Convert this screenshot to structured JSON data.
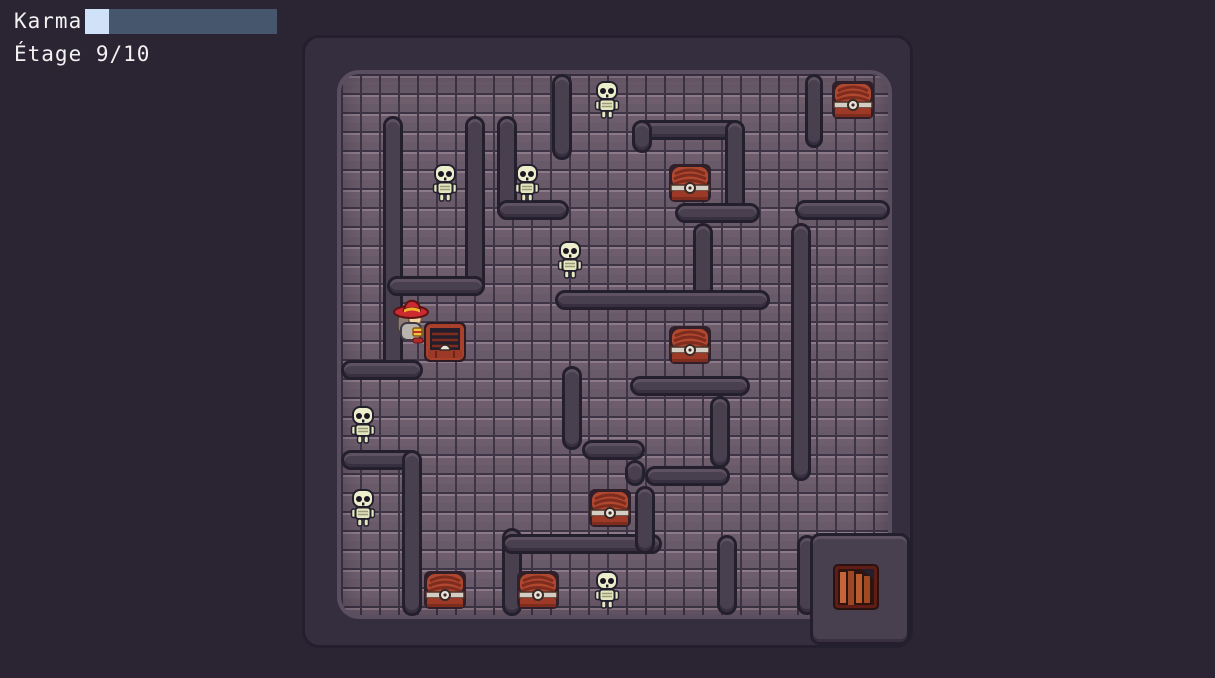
{
  "hud": {
    "karma_label": "Karma",
    "karma_percent": 12.5,
    "floor_label": "Étage 9/10"
  },
  "colors": {
    "background": "#2a2433",
    "hud_text": "#f2f2f2",
    "karma_bar_track": "#46566c",
    "karma_bar_fill": "#cfe2f8",
    "floor_tile": "#6e5e6d",
    "floor_grout": "#3d3545",
    "floor_highlight": "#8d7a88",
    "wall": "#49404f",
    "wall_outline": "#241f2d",
    "skeleton_bone": "#edefcc",
    "chest_wood": "#b04830",
    "chest_band": "#d3cdc4",
    "player_hat": "#cb2a30",
    "trapdoor_plank": "#c4663a"
  },
  "map": {
    "left": 305,
    "top": 38,
    "width": 605,
    "height": 607,
    "floor_inset": {
      "left": 36,
      "top": 36,
      "right": 22,
      "bottom": 30
    },
    "walls": [
      [
        78,
        78,
        20,
        264
      ],
      [
        160,
        78,
        20,
        180
      ],
      [
        82,
        238,
        98,
        20
      ],
      [
        36,
        322,
        82,
        20
      ],
      [
        192,
        78,
        20,
        104
      ],
      [
        192,
        162,
        72,
        20
      ],
      [
        247,
        36,
        20,
        86
      ],
      [
        327,
        82,
        113,
        20
      ],
      [
        327,
        82,
        20,
        33
      ],
      [
        420,
        82,
        20,
        103
      ],
      [
        370,
        165,
        85,
        20
      ],
      [
        388,
        185,
        20,
        77
      ],
      [
        250,
        252,
        215,
        20
      ],
      [
        325,
        338,
        120,
        20
      ],
      [
        257,
        328,
        20,
        84
      ],
      [
        277,
        402,
        63,
        20
      ],
      [
        320,
        422,
        20,
        26
      ],
      [
        340,
        428,
        85,
        20
      ],
      [
        405,
        358,
        20,
        72
      ],
      [
        486,
        185,
        20,
        258
      ],
      [
        490,
        162,
        95,
        20
      ],
      [
        500,
        36,
        18,
        74
      ],
      [
        36,
        412,
        80,
        20
      ],
      [
        97,
        412,
        20,
        166
      ],
      [
        197,
        490,
        20,
        88
      ],
      [
        197,
        496,
        160,
        20
      ],
      [
        330,
        448,
        20,
        68
      ],
      [
        412,
        497,
        20,
        80
      ],
      [
        492,
        497,
        20,
        80
      ],
      [
        505,
        495,
        100,
        112
      ]
    ],
    "entities": [
      {
        "type": "skeleton",
        "x": 302,
        "y": 62
      },
      {
        "type": "skeleton",
        "x": 140,
        "y": 145
      },
      {
        "type": "skeleton",
        "x": 222,
        "y": 145
      },
      {
        "type": "skeleton",
        "x": 265,
        "y": 222
      },
      {
        "type": "skeleton",
        "x": 58,
        "y": 387
      },
      {
        "type": "skeleton",
        "x": 58,
        "y": 470
      },
      {
        "type": "skeleton",
        "x": 302,
        "y": 552
      },
      {
        "type": "chest",
        "x": 548,
        "y": 62
      },
      {
        "type": "chest",
        "x": 385,
        "y": 145
      },
      {
        "type": "chest",
        "x": 385,
        "y": 307
      },
      {
        "type": "chest",
        "x": 305,
        "y": 470
      },
      {
        "type": "chest",
        "x": 233,
        "y": 552
      },
      {
        "type": "chest",
        "x": 140,
        "y": 552
      },
      {
        "type": "chest_open",
        "x": 140,
        "y": 304
      },
      {
        "type": "trapdoor",
        "x": 551,
        "y": 549
      },
      {
        "type": "player",
        "x": 107,
        "y": 284
      }
    ]
  }
}
